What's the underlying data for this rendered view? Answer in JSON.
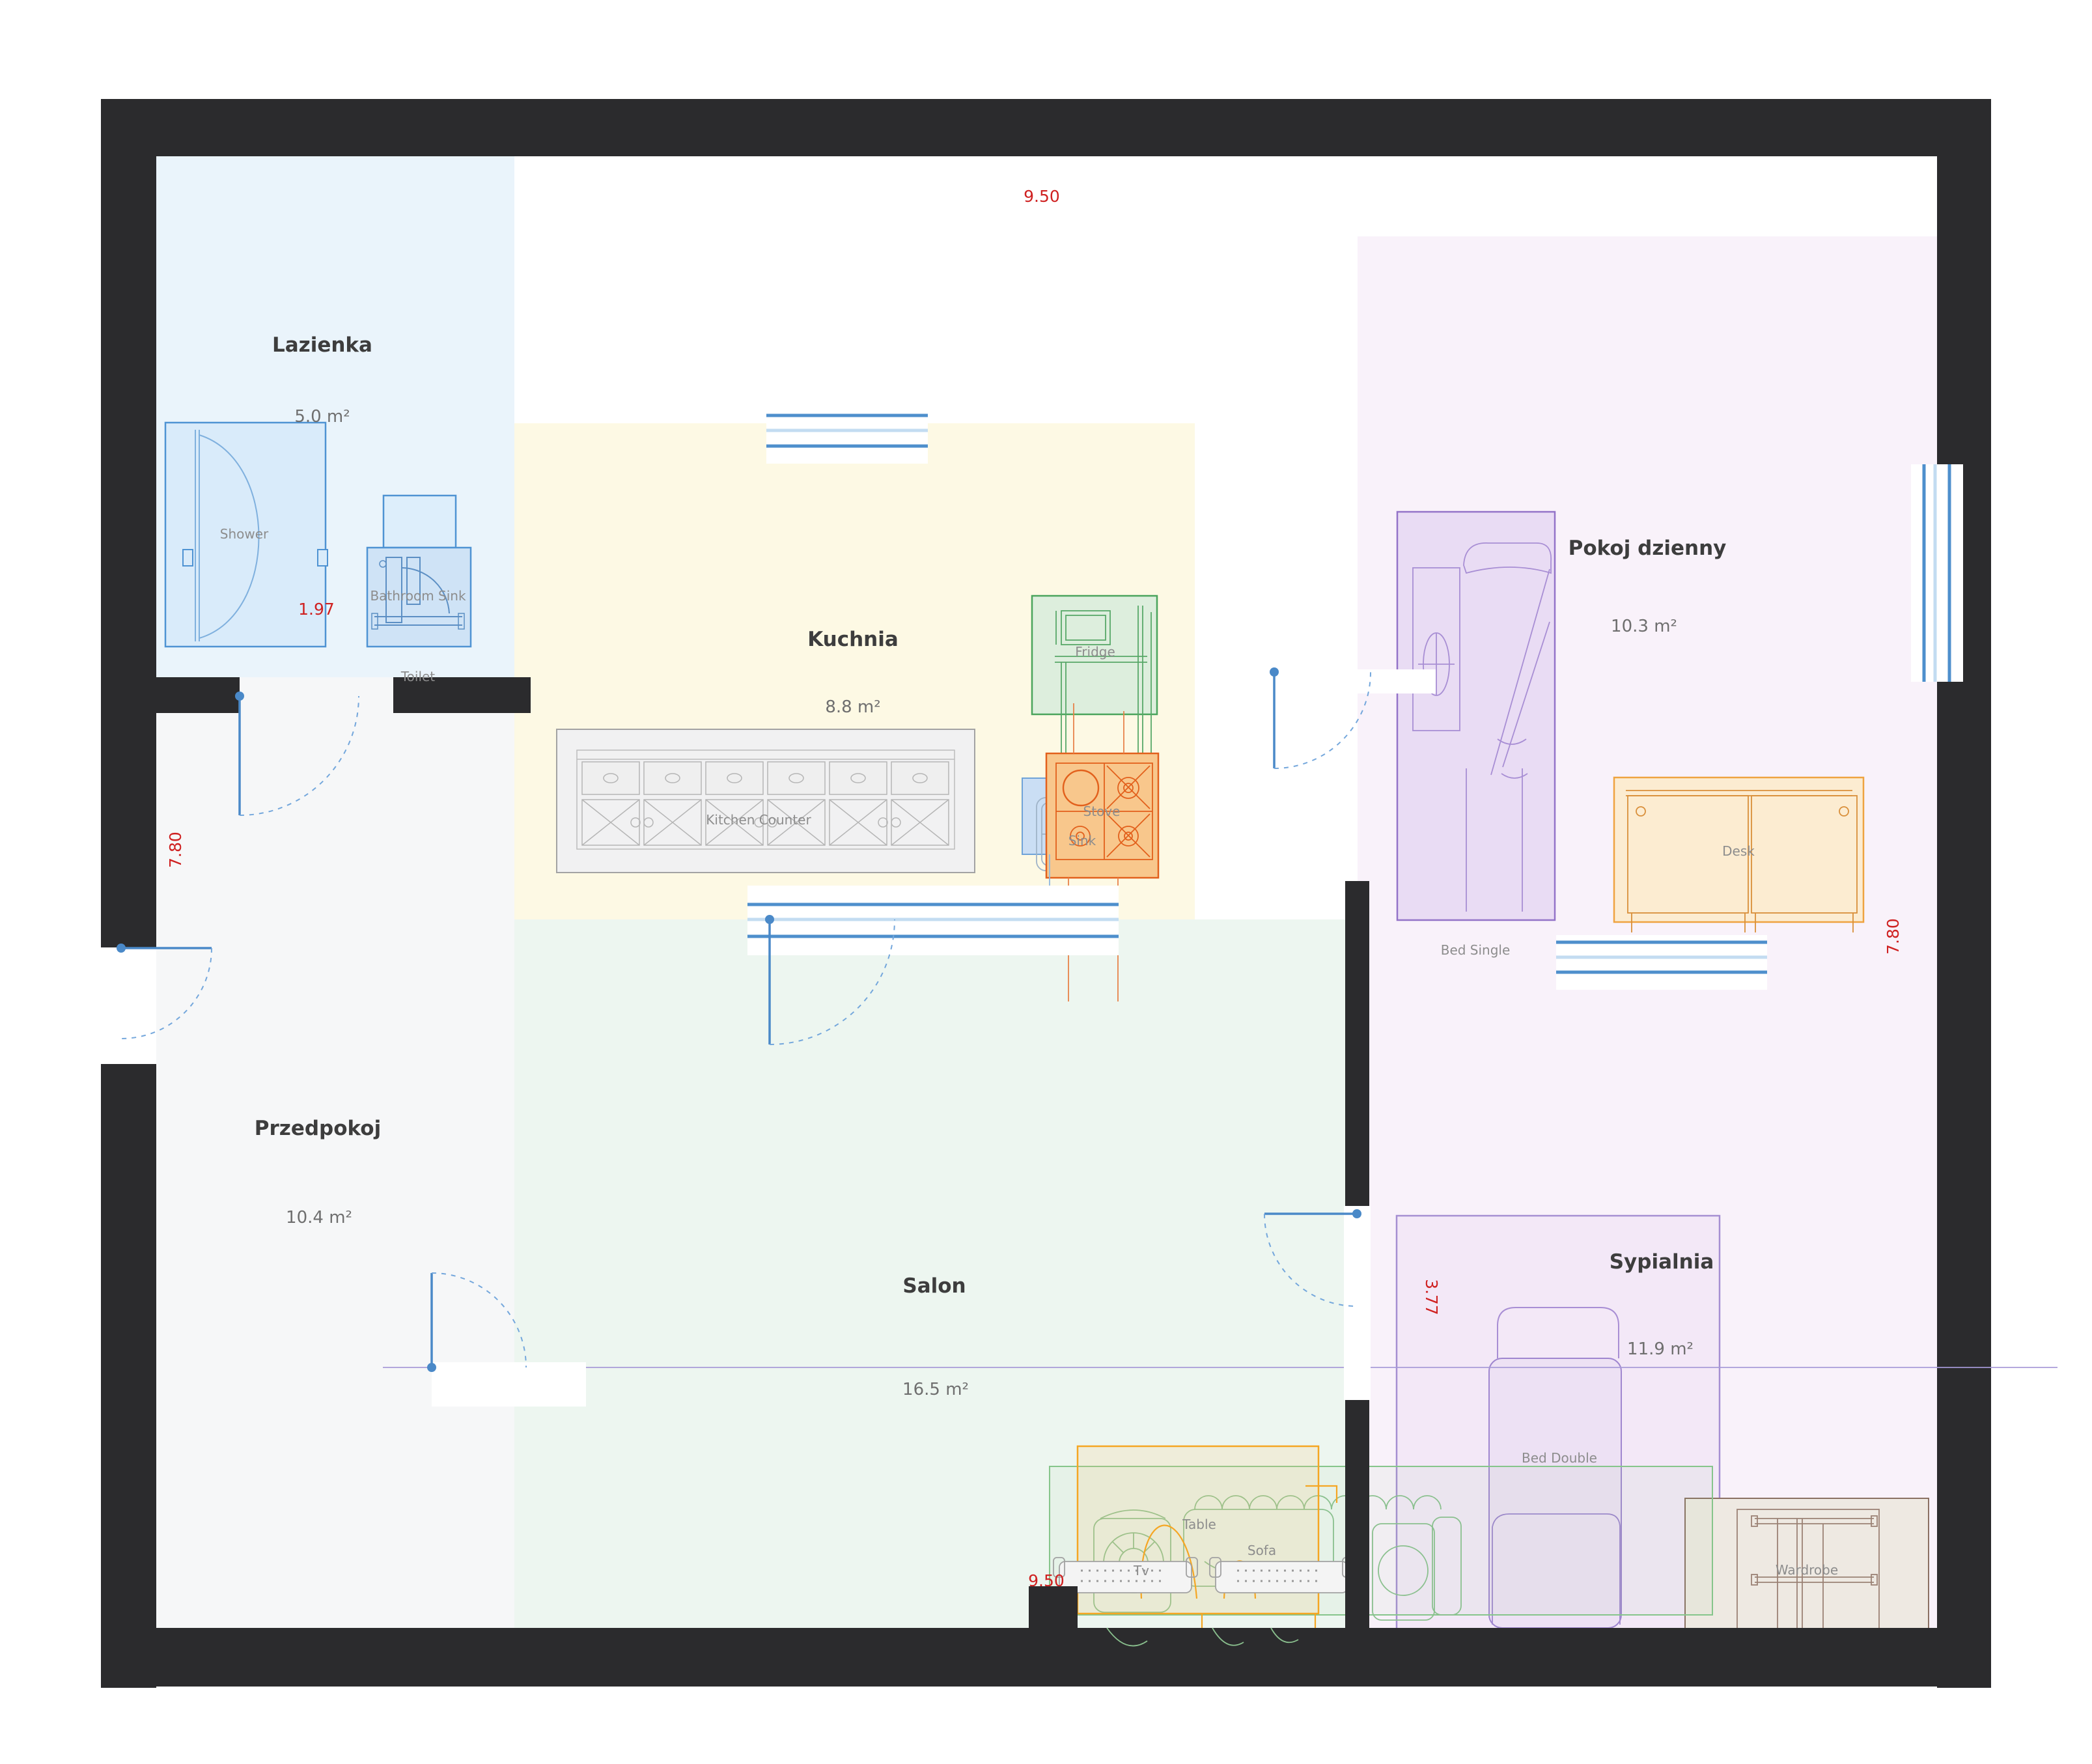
{
  "rooms": [
    {
      "name": "Lazienka",
      "area": "5.0 m²"
    },
    {
      "name": "Kuchnia",
      "area": "8.8 m²"
    },
    {
      "name": "Pokoj dzienny",
      "area": "10.3 m²"
    },
    {
      "name": "Przedpokoj",
      "area": "10.4 m²"
    },
    {
      "name": "Salon",
      "area": "16.5 m²"
    },
    {
      "name": "Sypialnia",
      "area": "11.9 m²"
    }
  ],
  "furniture": {
    "shower": "Shower",
    "bathroom_sink": "Bathroom Sink",
    "toilet": "Toilet",
    "kitchen_counter": "Kitchen Counter",
    "fridge": "Fridge",
    "stove": "Stove",
    "sink": "Sink",
    "bed_single": "Bed Single",
    "desk": "Desk",
    "bed_double": "Bed Double",
    "wardrobe": "Wardrobe",
    "table": "Table",
    "sofa": "Sofa",
    "tv": "Tv"
  },
  "dimensions": {
    "top": "9.50",
    "bottom": "9.50",
    "left": "7.80",
    "right": "7.80",
    "bathroom_width": "1.97",
    "bedroom_width": "3.77"
  },
  "colors": {
    "wall": "#2b2b2d",
    "dimension_red": "#cf2121",
    "door_window_blue": "#4f93d3",
    "window_light_blue": "#c3dcf1",
    "room_lazienka": "#eaf4fb",
    "room_kuchnia": "#fdf9e4",
    "room_przedpokoj": "#f6f7f8",
    "room_salon": "#edf6f0",
    "room_pokoj_dzienny": "#f9f2fa",
    "room_sypialnia": "#f3e8f7",
    "accent_fridge_green": "#4aa45c",
    "accent_stove_orange": "#e2601c",
    "accent_desk_orange": "#efa340",
    "accent_table_orange": "#f5a623",
    "accent_sofa_green": "#86c58b",
    "accent_bed_purple": "#9373c8",
    "accent_wardrobe_brown": "#8b7163",
    "counter_gray": "#a3a3a3"
  }
}
